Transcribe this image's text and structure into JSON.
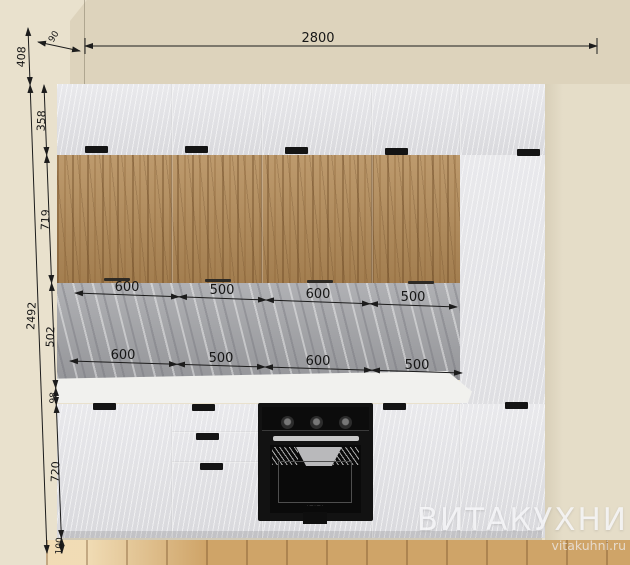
{
  "watermark": {
    "brand": "ВИТАКУХНИ",
    "site": "vitakuhni.ru"
  },
  "dimensions": {
    "overall_width": "2800",
    "wall_gap": "90",
    "left_heights": {
      "top_offset": "408",
      "upper_cabinet": "358",
      "wood_doors": "719",
      "overall_height": "2492",
      "backsplash": "502",
      "countertop": "98",
      "base_cabinet": "720",
      "plinth": "100"
    },
    "upper_widths": [
      "600",
      "500",
      "600",
      "500"
    ],
    "lower_widths": [
      "600",
      "500",
      "600",
      "500"
    ]
  },
  "colors": {
    "wall": "#e7dfca",
    "wall_shadow": "#ddd3bc",
    "cabinet_white": "#e2e2e6",
    "wood": "#b18a58",
    "marble": "#a2a3a7",
    "countertop": "#f1f1ee",
    "floor": "#cfa468",
    "oven": "#121212",
    "dimension_line": "#1c1c1c",
    "watermark": "#fafafc"
  }
}
